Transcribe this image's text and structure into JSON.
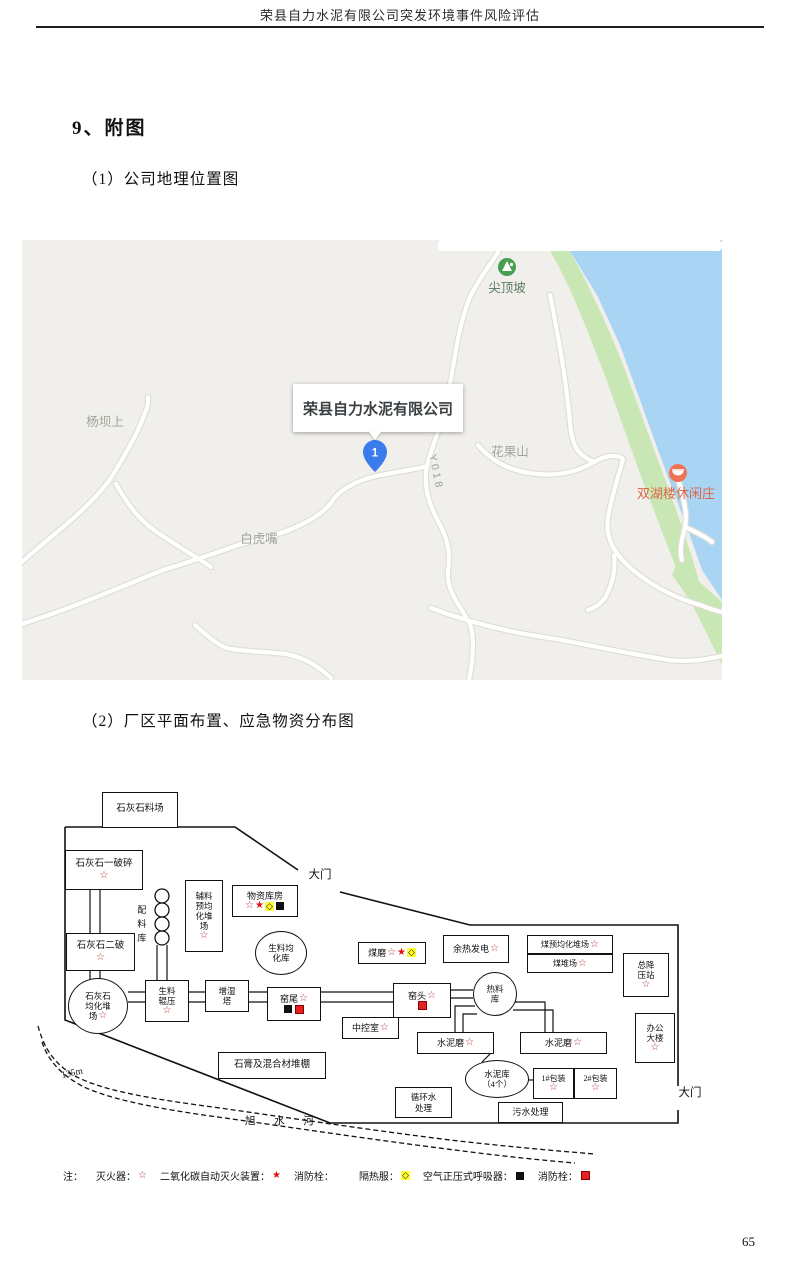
{
  "document": {
    "header": "荣县自力水泥有限公司突发环境事件风险评估",
    "section_title": "9、附图",
    "caption1": "（1）公司地理位置图",
    "caption2": "（2）厂区平面布置、应急物资分布图",
    "page_number": "65"
  },
  "map": {
    "company_label": "荣县自力水泥有限公司",
    "marker_number": "1",
    "poi_peak": "尖顶坡",
    "poi_mountain": "花果山",
    "poi_west": "杨坝上",
    "poi_south": "白虎嘴",
    "poi_resort": "双湖楼休闲庄",
    "road_label": "Y018",
    "colors": {
      "land": "#f0efeb",
      "water": "#a9d4f4",
      "shore_green": "#c9e7b5",
      "road": "#ffffff",
      "marker_blue": "#3a7cec",
      "resort_orange": "#ef7352",
      "poi_green": "#46a04f",
      "label_gray": "#9aa09a"
    }
  },
  "plant": {
    "contour_label": "135m",
    "river_label": "旭  水  河",
    "legend_note": "注：",
    "legend": [
      {
        "label": "灭火器：",
        "sym": "s"
      },
      {
        "label": "二氧化碳自动灭火装置：",
        "sym": "f"
      },
      {
        "label": "消防栓：",
        "sym": "none"
      },
      {
        "label": "隔热服：",
        "sym": "d"
      },
      {
        "label": "空气正压式呼吸器：",
        "sym": "b"
      },
      {
        "label": "消防栓：",
        "sym": "r"
      }
    ],
    "facilities": [
      {
        "id": "limestone-yard",
        "shape": "rect",
        "x": 72,
        "y": 12,
        "w": 76,
        "h": 36,
        "fs": 9.5,
        "label": "石灰石料场"
      },
      {
        "id": "limestone-crusher-1",
        "shape": "rect",
        "x": 35,
        "y": 70,
        "w": 78,
        "h": 40,
        "fs": 9.5,
        "label": "石灰石一破碎\n[s]"
      },
      {
        "id": "limestone-crusher-2",
        "shape": "rect",
        "x": 36,
        "y": 153,
        "w": 69,
        "h": 38,
        "fs": 9.5,
        "label": "石灰石二破\n[s]"
      },
      {
        "id": "limestone-blending-yard",
        "shape": "ellipse",
        "x": 38,
        "y": 198,
        "w": 60,
        "h": 56,
        "fs": 8.5,
        "label": "石灰石\n均化堆\n场[s]"
      },
      {
        "id": "batching-silo",
        "shape": "vtext",
        "x": 104,
        "y": 118,
        "w": 14,
        "h": 56,
        "fs": 9,
        "label": "配料库"
      },
      {
        "id": "aux-preblending-yard",
        "shape": "rect",
        "x": 155,
        "y": 100,
        "w": 38,
        "h": 72,
        "fs": 8.5,
        "label": "辅料\n预均\n化堆\n场\n[s]"
      },
      {
        "id": "material-warehouse",
        "shape": "rect",
        "x": 202,
        "y": 105,
        "w": 66,
        "h": 32,
        "fs": 9,
        "label": "物资库房\n[s][f][d][b]"
      },
      {
        "id": "raw-meal-silo",
        "shape": "ellipse",
        "x": 225,
        "y": 151,
        "w": 52,
        "h": 44,
        "fs": 8.5,
        "label": "生料均\n化库"
      },
      {
        "id": "gate-top",
        "shape": "text",
        "x": 268,
        "y": 88,
        "w": 44,
        "h": 16,
        "fs": 11.5,
        "label": "大门"
      },
      {
        "id": "coal-mill",
        "shape": "rect",
        "x": 328,
        "y": 162,
        "w": 68,
        "h": 22,
        "fs": 9,
        "label": "煤磨[s][f][d]"
      },
      {
        "id": "waste-heat-power",
        "shape": "rect",
        "x": 413,
        "y": 155,
        "w": 66,
        "h": 28,
        "fs": 9,
        "label": "余热发电[s]"
      },
      {
        "id": "coal-preblending-yard",
        "shape": "rect",
        "x": 497,
        "y": 155,
        "w": 86,
        "h": 19,
        "fs": 8,
        "label": "煤预均化堆场[s]"
      },
      {
        "id": "coal-yard",
        "shape": "rect",
        "x": 497,
        "y": 174,
        "w": 86,
        "h": 19,
        "fs": 8,
        "label": "煤堆场[s]"
      },
      {
        "id": "main-substation",
        "shape": "rect",
        "x": 593,
        "y": 173,
        "w": 46,
        "h": 44,
        "fs": 8.5,
        "label": "总降\n压站\n[s]"
      },
      {
        "id": "raw-meal-roller-press",
        "shape": "rect",
        "x": 115,
        "y": 200,
        "w": 44,
        "h": 42,
        "fs": 8.5,
        "label": "生料\n辊压\n[s]"
      },
      {
        "id": "humidifier-tower",
        "shape": "rect",
        "x": 175,
        "y": 200,
        "w": 44,
        "h": 32,
        "fs": 8.5,
        "label": "增湿\n塔"
      },
      {
        "id": "kiln-tail",
        "shape": "rect",
        "x": 237,
        "y": 207,
        "w": 54,
        "h": 34,
        "fs": 9,
        "label": "窑尾[s]\n[b][r]"
      },
      {
        "id": "kiln-head",
        "shape": "rect",
        "x": 363,
        "y": 203,
        "w": 58,
        "h": 35,
        "fs": 9,
        "label": "窑头[s]\n[r]"
      },
      {
        "id": "hot-material-silo",
        "shape": "ellipse",
        "x": 443,
        "y": 192,
        "w": 44,
        "h": 44,
        "fs": 8.5,
        "label": "热料\n库"
      },
      {
        "id": "central-control-room",
        "shape": "rect",
        "x": 312,
        "y": 237,
        "w": 57,
        "h": 22,
        "fs": 9,
        "label": "中控室[s]"
      },
      {
        "id": "cement-mill-1",
        "shape": "rect",
        "x": 387,
        "y": 252,
        "w": 77,
        "h": 22,
        "fs": 9,
        "label": "水泥磨[s]"
      },
      {
        "id": "cement-mill-2",
        "shape": "rect",
        "x": 490,
        "y": 252,
        "w": 87,
        "h": 22,
        "fs": 9,
        "label": "水泥磨[s]"
      },
      {
        "id": "office-building",
        "shape": "rect",
        "x": 605,
        "y": 233,
        "w": 40,
        "h": 50,
        "fs": 8.5,
        "label": "办公\n大楼\n[s]"
      },
      {
        "id": "gypsum-shed",
        "shape": "rect",
        "x": 188,
        "y": 272,
        "w": 108,
        "h": 27,
        "fs": 9.5,
        "label": "石膏及混合材堆棚"
      },
      {
        "id": "cement-silos",
        "shape": "ellipse",
        "x": 435,
        "y": 280,
        "w": 64,
        "h": 38,
        "fs": 8.5,
        "label": "水泥库\n（4个）"
      },
      {
        "id": "packing-1",
        "shape": "rect",
        "x": 503,
        "y": 288,
        "w": 41,
        "h": 31,
        "fs": 8,
        "label": "1#包装\n[s]"
      },
      {
        "id": "packing-2",
        "shape": "rect",
        "x": 544,
        "y": 288,
        "w": 43,
        "h": 31,
        "fs": 8,
        "label": "2#包装\n[s]"
      },
      {
        "id": "circulating-water",
        "shape": "rect",
        "x": 365,
        "y": 307,
        "w": 57,
        "h": 31,
        "fs": 8.5,
        "label": "循环水\n处理"
      },
      {
        "id": "sewage-treatment",
        "shape": "rect",
        "x": 468,
        "y": 322,
        "w": 65,
        "h": 21,
        "fs": 9,
        "label": "污水处理"
      },
      {
        "id": "gate-right",
        "shape": "text",
        "x": 638,
        "y": 306,
        "w": 44,
        "h": 16,
        "fs": 11.5,
        "label": "大门"
      }
    ]
  }
}
